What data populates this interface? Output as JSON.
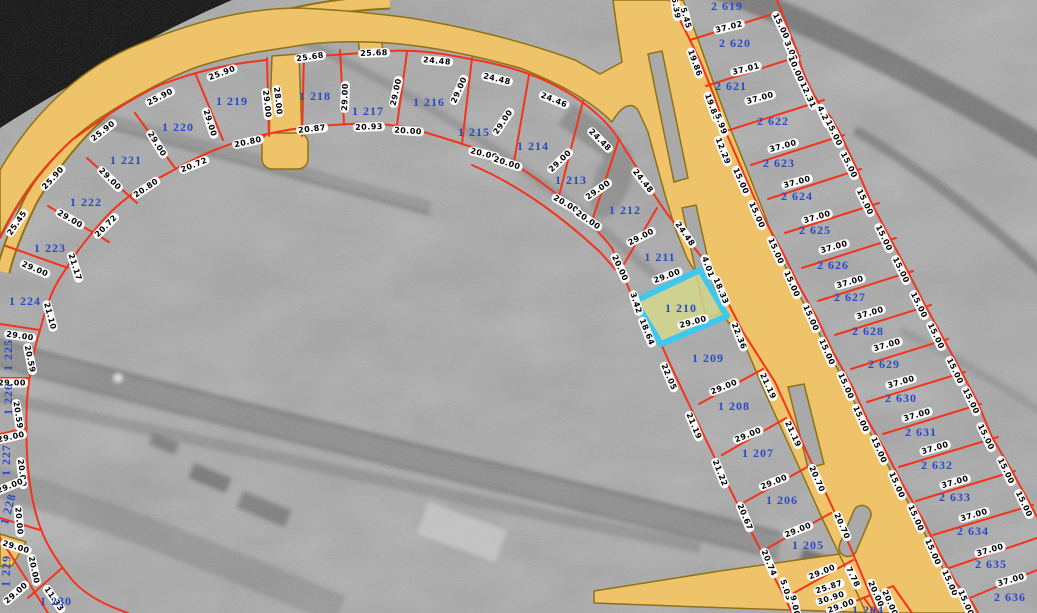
{
  "map_view": {
    "selected_parcel": "1 210",
    "colors": {
      "road_fill": "#EFC36A",
      "road_border": "#8F7213",
      "parcel_line": "#F5331B",
      "parcel_number": "#2A4BC6",
      "dim_bg": "#FFFFFF",
      "dim_text": "#000000",
      "highlight_stroke": "#3EC8F0",
      "highlight_fill": "#D8DB8C",
      "water": "#121212",
      "ground": "#A9A9A9"
    },
    "parcel_labels": [
      {
        "text": "1 219",
        "x": 232,
        "y": 101,
        "r": 0
      },
      {
        "text": "1 220",
        "x": 178,
        "y": 127,
        "r": 0
      },
      {
        "text": "1 221",
        "x": 126,
        "y": 160,
        "r": 0
      },
      {
        "text": "1 222",
        "x": 86,
        "y": 202,
        "r": 0
      },
      {
        "text": "1 223",
        "x": 50,
        "y": 248,
        "r": 0
      },
      {
        "text": "1 224",
        "x": 25,
        "y": 301,
        "r": 0
      },
      {
        "text": "1 225",
        "x": 8,
        "y": 355,
        "r": -90
      },
      {
        "text": "1 226",
        "x": 8,
        "y": 399,
        "r": -90
      },
      {
        "text": "1 227",
        "x": 6,
        "y": 460,
        "r": -90
      },
      {
        "text": "1 228",
        "x": 8,
        "y": 509,
        "r": -75
      },
      {
        "text": "1 229",
        "x": 6,
        "y": 571,
        "r": -88
      },
      {
        "text": "1 230",
        "x": 56,
        "y": 601,
        "r": 0
      },
      {
        "text": "1 218",
        "x": 315,
        "y": 96,
        "r": 0
      },
      {
        "text": "1 217",
        "x": 368,
        "y": 111,
        "r": 0
      },
      {
        "text": "1 216",
        "x": 429,
        "y": 102,
        "r": 0
      },
      {
        "text": "1 215",
        "x": 474,
        "y": 132,
        "r": 0
      },
      {
        "text": "1 214",
        "x": 533,
        "y": 146,
        "r": 0
      },
      {
        "text": "1 213",
        "x": 571,
        "y": 180,
        "r": 0
      },
      {
        "text": "1 212",
        "x": 625,
        "y": 210,
        "r": 0
      },
      {
        "text": "1 211",
        "x": 660,
        "y": 257,
        "r": 0
      },
      {
        "text": "1 210",
        "x": 681,
        "y": 308,
        "r": 0
      },
      {
        "text": "1 209",
        "x": 708,
        "y": 358,
        "r": 0
      },
      {
        "text": "1 208",
        "x": 734,
        "y": 406,
        "r": 0
      },
      {
        "text": "1 207",
        "x": 758,
        "y": 453,
        "r": 0
      },
      {
        "text": "1 206",
        "x": 782,
        "y": 500,
        "r": 0
      },
      {
        "text": "1 205",
        "x": 808,
        "y": 545,
        "r": 0
      },
      {
        "text": "1 204",
        "x": 868,
        "y": 610,
        "r": 0
      },
      {
        "text": "2 619",
        "x": 727,
        "y": 6,
        "r": 0
      },
      {
        "text": "2 620",
        "x": 735,
        "y": 43,
        "r": 0
      },
      {
        "text": "2 621",
        "x": 731,
        "y": 86,
        "r": 0
      },
      {
        "text": "2 622",
        "x": 773,
        "y": 121,
        "r": 0
      },
      {
        "text": "2 623",
        "x": 779,
        "y": 163,
        "r": 0
      },
      {
        "text": "2 624",
        "x": 797,
        "y": 196,
        "r": 0
      },
      {
        "text": "2 625",
        "x": 815,
        "y": 230,
        "r": 0
      },
      {
        "text": "2 626",
        "x": 833,
        "y": 265,
        "r": 0
      },
      {
        "text": "2 627",
        "x": 850,
        "y": 297,
        "r": 0
      },
      {
        "text": "2 628",
        "x": 868,
        "y": 331,
        "r": 0
      },
      {
        "text": "2 629",
        "x": 884,
        "y": 364,
        "r": 0
      },
      {
        "text": "2 630",
        "x": 901,
        "y": 398,
        "r": 0
      },
      {
        "text": "2 631",
        "x": 921,
        "y": 432,
        "r": 0
      },
      {
        "text": "2 632",
        "x": 937,
        "y": 465,
        "r": 0
      },
      {
        "text": "2 633",
        "x": 955,
        "y": 497,
        "r": 0
      },
      {
        "text": "2 634",
        "x": 973,
        "y": 531,
        "r": 0
      },
      {
        "text": "2 635",
        "x": 991,
        "y": 564,
        "r": 0
      },
      {
        "text": "2 636",
        "x": 1010,
        "y": 597,
        "r": 0
      }
    ],
    "dimension_labels": [
      {
        "text": "25.90",
        "x": 222,
        "y": 73,
        "r": -20
      },
      {
        "text": "25.90",
        "x": 160,
        "y": 97,
        "r": -27
      },
      {
        "text": "25.90",
        "x": 103,
        "y": 131,
        "r": -38
      },
      {
        "text": "25.90",
        "x": 53,
        "y": 178,
        "r": -47
      },
      {
        "text": "25.45",
        "x": 17,
        "y": 223,
        "r": -55
      },
      {
        "text": "25.68",
        "x": 310,
        "y": 57,
        "r": -8
      },
      {
        "text": "25.68",
        "x": 374,
        "y": 53,
        "r": -2
      },
      {
        "text": "24.48",
        "x": 437,
        "y": 61,
        "r": 5
      },
      {
        "text": "24.48",
        "x": 497,
        "y": 79,
        "r": 13
      },
      {
        "text": "24.46",
        "x": 554,
        "y": 100,
        "r": 22
      },
      {
        "text": "24.48",
        "x": 600,
        "y": 140,
        "r": 45
      },
      {
        "text": "24.48",
        "x": 643,
        "y": 181,
        "r": 52
      },
      {
        "text": "24.48",
        "x": 685,
        "y": 234,
        "r": 55
      },
      {
        "text": "4.01",
        "x": 708,
        "y": 267,
        "r": 70
      },
      {
        "text": "18.33",
        "x": 721,
        "y": 291,
        "r": 67
      },
      {
        "text": "22.36",
        "x": 739,
        "y": 336,
        "r": 68
      },
      {
        "text": "21.19",
        "x": 768,
        "y": 386,
        "r": 65
      },
      {
        "text": "21.19",
        "x": 793,
        "y": 434,
        "r": 65
      },
      {
        "text": "20.70",
        "x": 817,
        "y": 479,
        "r": 66
      },
      {
        "text": "20.70",
        "x": 842,
        "y": 526,
        "r": 66
      },
      {
        "text": "20.80",
        "x": 248,
        "y": 142,
        "r": -12
      },
      {
        "text": "20.72",
        "x": 194,
        "y": 165,
        "r": -22
      },
      {
        "text": "20.80",
        "x": 146,
        "y": 188,
        "r": -34
      },
      {
        "text": "20.72",
        "x": 106,
        "y": 226,
        "r": -45
      },
      {
        "text": "20.87",
        "x": 312,
        "y": 129,
        "r": -6
      },
      {
        "text": "20.93",
        "x": 369,
        "y": 127,
        "r": -2
      },
      {
        "text": "20.00",
        "x": 408,
        "y": 131,
        "r": 4
      },
      {
        "text": "20.00",
        "x": 484,
        "y": 154,
        "r": 14
      },
      {
        "text": "20.00",
        "x": 507,
        "y": 163,
        "r": 18
      },
      {
        "text": "20.00",
        "x": 566,
        "y": 204,
        "r": 30
      },
      {
        "text": "20.00",
        "x": 588,
        "y": 220,
        "r": 34
      },
      {
        "text": "20.00",
        "x": 620,
        "y": 268,
        "r": 65
      },
      {
        "text": "21.17",
        "x": 75,
        "y": 267,
        "r": 72
      },
      {
        "text": "21.10",
        "x": 50,
        "y": 316,
        "r": 75
      },
      {
        "text": "20.59",
        "x": 30,
        "y": 359,
        "r": 78
      },
      {
        "text": "20.59",
        "x": 18,
        "y": 415,
        "r": 81
      },
      {
        "text": "20.00",
        "x": 22,
        "y": 473,
        "r": 83
      },
      {
        "text": "20.00",
        "x": 19,
        "y": 521,
        "r": 85
      },
      {
        "text": "20.00",
        "x": 34,
        "y": 570,
        "r": 78
      },
      {
        "text": "11.33",
        "x": 54,
        "y": 599,
        "r": 55
      },
      {
        "text": "29.00",
        "x": 210,
        "y": 123,
        "r": 72
      },
      {
        "text": "29.00",
        "x": 267,
        "y": 104,
        "r": 84
      },
      {
        "text": "28.00",
        "x": 278,
        "y": 101,
        "r": 84
      },
      {
        "text": "29.00",
        "x": 157,
        "y": 144,
        "r": 58
      },
      {
        "text": "29.00",
        "x": 110,
        "y": 179,
        "r": 45
      },
      {
        "text": "29.00",
        "x": 70,
        "y": 219,
        "r": 30
      },
      {
        "text": "29.00",
        "x": 35,
        "y": 269,
        "r": 23
      },
      {
        "text": "29.00",
        "x": 20,
        "y": 336,
        "r": 8
      },
      {
        "text": "29.00",
        "x": 12,
        "y": 383,
        "r": 0
      },
      {
        "text": "29.00",
        "x": 11,
        "y": 437,
        "r": -12
      },
      {
        "text": "29.00",
        "x": 10,
        "y": 486,
        "r": -22
      },
      {
        "text": "29.00",
        "x": 16,
        "y": 547,
        "r": 17
      },
      {
        "text": "29.00",
        "x": 16,
        "y": 593,
        "r": -41
      },
      {
        "text": "29.00",
        "x": 345,
        "y": 97,
        "r": -88
      },
      {
        "text": "29.00",
        "x": 396,
        "y": 92,
        "r": -78
      },
      {
        "text": "29.00",
        "x": 459,
        "y": 90,
        "r": -66
      },
      {
        "text": "29.00",
        "x": 503,
        "y": 122,
        "r": -56
      },
      {
        "text": "29.00",
        "x": 560,
        "y": 161,
        "r": -44
      },
      {
        "text": "29.00",
        "x": 598,
        "y": 190,
        "r": -35
      },
      {
        "text": "29.00",
        "x": 641,
        "y": 237,
        "r": -27
      },
      {
        "text": "29.00",
        "x": 667,
        "y": 276,
        "r": -20
      },
      {
        "text": "3.42",
        "x": 636,
        "y": 303,
        "r": 72
      },
      {
        "text": "18.64",
        "x": 647,
        "y": 332,
        "r": 68
      },
      {
        "text": "29.00",
        "x": 693,
        "y": 322,
        "r": -15
      },
      {
        "text": "22.05",
        "x": 669,
        "y": 377,
        "r": 67
      },
      {
        "text": "21.19",
        "x": 694,
        "y": 426,
        "r": 67
      },
      {
        "text": "21.22",
        "x": 720,
        "y": 473,
        "r": 68
      },
      {
        "text": "20.67",
        "x": 745,
        "y": 517,
        "r": 67
      },
      {
        "text": "20.74",
        "x": 769,
        "y": 563,
        "r": 67
      },
      {
        "text": "29.00",
        "x": 724,
        "y": 387,
        "r": -22
      },
      {
        "text": "29.00",
        "x": 748,
        "y": 435,
        "r": -22
      },
      {
        "text": "29.00",
        "x": 774,
        "y": 482,
        "r": -22
      },
      {
        "text": "29.00",
        "x": 798,
        "y": 530,
        "r": -22
      },
      {
        "text": "29.00",
        "x": 822,
        "y": 572,
        "r": -22
      },
      {
        "text": "29.00",
        "x": 841,
        "y": 606,
        "r": -20
      },
      {
        "text": "25.87",
        "x": 829,
        "y": 587,
        "r": -18
      },
      {
        "text": "30.90",
        "x": 831,
        "y": 598,
        "r": -18
      },
      {
        "text": "7.78",
        "x": 853,
        "y": 577,
        "r": 64
      },
      {
        "text": "5.03",
        "x": 786,
        "y": 590,
        "r": 72
      },
      {
        "text": "9.00",
        "x": 795,
        "y": 606,
        "r": 78
      },
      {
        "text": "20.00",
        "x": 876,
        "y": 594,
        "r": 66
      },
      {
        "text": "20.00",
        "x": 890,
        "y": 603,
        "r": 66
      },
      {
        "text": "6.39",
        "x": 676,
        "y": 8,
        "r": 80
      },
      {
        "text": "5.45",
        "x": 686,
        "y": 18,
        "r": 74
      },
      {
        "text": "19.86",
        "x": 695,
        "y": 63,
        "r": 70
      },
      {
        "text": "19.86",
        "x": 712,
        "y": 107,
        "r": 70
      },
      {
        "text": "5.99",
        "x": 721,
        "y": 124,
        "r": 70
      },
      {
        "text": "12.29",
        "x": 723,
        "y": 151,
        "r": 68
      },
      {
        "text": "15.00",
        "x": 741,
        "y": 181,
        "r": 66
      },
      {
        "text": "15.00",
        "x": 757,
        "y": 215,
        "r": 66
      },
      {
        "text": "15.00",
        "x": 776,
        "y": 251,
        "r": 66
      },
      {
        "text": "15.00",
        "x": 792,
        "y": 284,
        "r": 66
      },
      {
        "text": "15.00",
        "x": 811,
        "y": 318,
        "r": 66
      },
      {
        "text": "15.00",
        "x": 827,
        "y": 352,
        "r": 66
      },
      {
        "text": "15.00",
        "x": 846,
        "y": 386,
        "r": 66
      },
      {
        "text": "15.00",
        "x": 861,
        "y": 419,
        "r": 66
      },
      {
        "text": "15.00",
        "x": 879,
        "y": 450,
        "r": 66
      },
      {
        "text": "15.00",
        "x": 897,
        "y": 485,
        "r": 66
      },
      {
        "text": "15.00",
        "x": 916,
        "y": 518,
        "r": 66
      },
      {
        "text": "15.00",
        "x": 933,
        "y": 552,
        "r": 66
      },
      {
        "text": "15.00",
        "x": 950,
        "y": 583,
        "r": 66
      },
      {
        "text": "15.00",
        "x": 966,
        "y": 603,
        "r": 66
      },
      {
        "text": "15.00",
        "x": 781,
        "y": 26,
        "r": 64
      },
      {
        "text": "3.00",
        "x": 791,
        "y": 51,
        "r": 66
      },
      {
        "text": "10.00",
        "x": 796,
        "y": 69,
        "r": 66
      },
      {
        "text": "12.31",
        "x": 808,
        "y": 95,
        "r": 65
      },
      {
        "text": "4.29",
        "x": 824,
        "y": 116,
        "r": 65
      },
      {
        "text": "15.00",
        "x": 834,
        "y": 133,
        "r": 64
      },
      {
        "text": "15.00",
        "x": 849,
        "y": 165,
        "r": 64
      },
      {
        "text": "15.00",
        "x": 865,
        "y": 202,
        "r": 64
      },
      {
        "text": "15.00",
        "x": 884,
        "y": 238,
        "r": 64
      },
      {
        "text": "15.00",
        "x": 901,
        "y": 270,
        "r": 64
      },
      {
        "text": "15.00",
        "x": 919,
        "y": 305,
        "r": 64
      },
      {
        "text": "15.00",
        "x": 936,
        "y": 336,
        "r": 64
      },
      {
        "text": "15.00",
        "x": 955,
        "y": 371,
        "r": 64
      },
      {
        "text": "15.00",
        "x": 971,
        "y": 401,
        "r": 64
      },
      {
        "text": "15.00",
        "x": 986,
        "y": 437,
        "r": 64
      },
      {
        "text": "15.00",
        "x": 1006,
        "y": 471,
        "r": 64
      },
      {
        "text": "15.00",
        "x": 1024,
        "y": 504,
        "r": 64
      },
      {
        "text": "37.02",
        "x": 729,
        "y": 27,
        "r": -14
      },
      {
        "text": "37.01",
        "x": 746,
        "y": 69,
        "r": -14
      },
      {
        "text": "37.00",
        "x": 760,
        "y": 98,
        "r": -15
      },
      {
        "text": "37.00",
        "x": 783,
        "y": 146,
        "r": -15
      },
      {
        "text": "37.00",
        "x": 797,
        "y": 182,
        "r": -15
      },
      {
        "text": "37.00",
        "x": 817,
        "y": 217,
        "r": -16
      },
      {
        "text": "37.00",
        "x": 834,
        "y": 247,
        "r": -16
      },
      {
        "text": "37.00",
        "x": 850,
        "y": 282,
        "r": -16
      },
      {
        "text": "37.00",
        "x": 870,
        "y": 313,
        "r": -16
      },
      {
        "text": "37.00",
        "x": 887,
        "y": 345,
        "r": -16
      },
      {
        "text": "37.00",
        "x": 901,
        "y": 382,
        "r": -16
      },
      {
        "text": "37.00",
        "x": 917,
        "y": 415,
        "r": -16
      },
      {
        "text": "37.00",
        "x": 935,
        "y": 448,
        "r": -16
      },
      {
        "text": "37.00",
        "x": 955,
        "y": 482,
        "r": -16
      },
      {
        "text": "37.00",
        "x": 974,
        "y": 515,
        "r": -16
      },
      {
        "text": "37.00",
        "x": 990,
        "y": 550,
        "r": -16
      },
      {
        "text": "37.00",
        "x": 1011,
        "y": 580,
        "r": -16
      }
    ]
  }
}
